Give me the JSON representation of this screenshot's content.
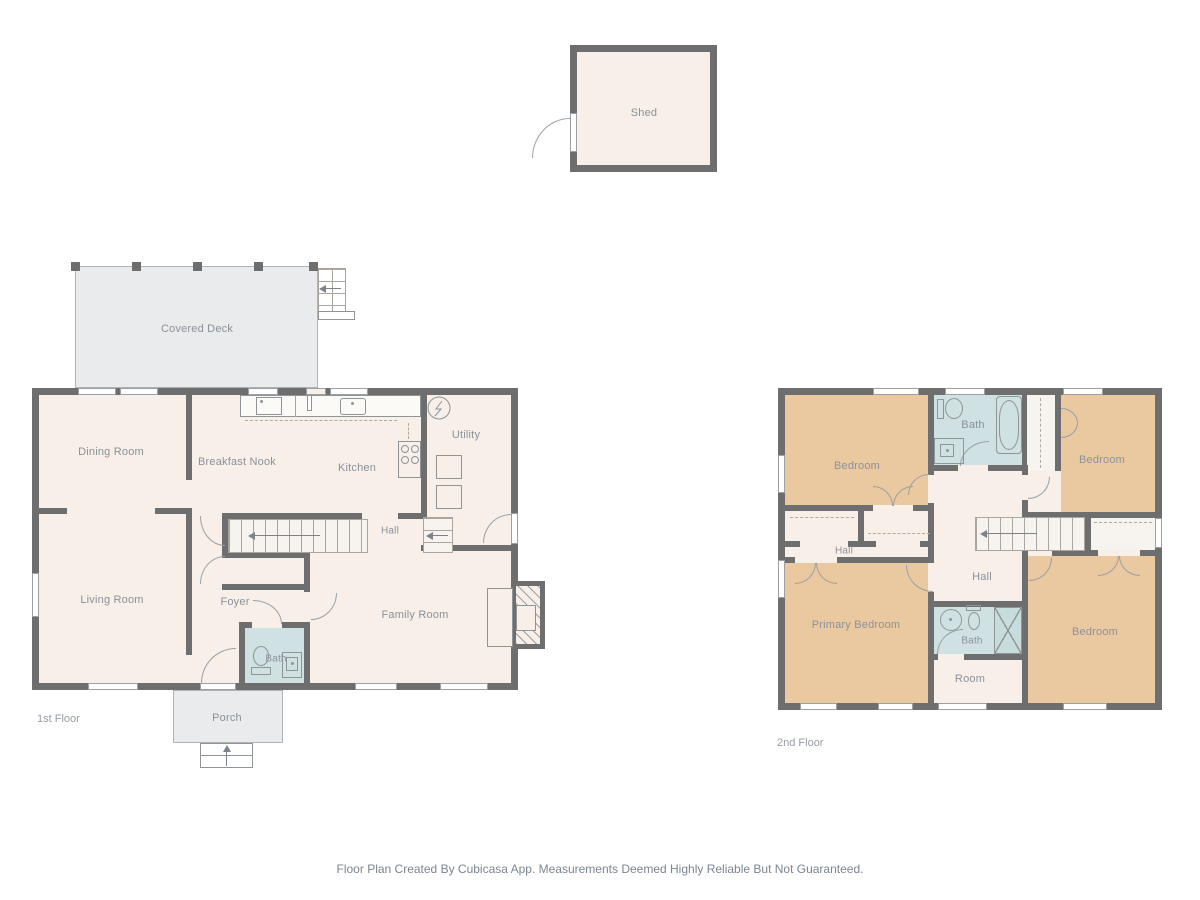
{
  "footer": {
    "text": "Floor Plan Created By Cubicasa App. Measurements Deemed Highly Reliable But Not Guaranteed."
  },
  "shed": {
    "label": "Shed"
  },
  "floor1": {
    "title": "1st Floor",
    "rooms": {
      "covered_deck": "Covered Deck",
      "dining_room": "Dining Room",
      "breakfast_nook": "Breakfast Nook",
      "kitchen": "Kitchen",
      "utility": "Utility",
      "hall": "Hall",
      "living_room": "Living Room",
      "foyer": "Foyer",
      "bath": "Bath",
      "family_room": "Family Room",
      "porch": "Porch"
    }
  },
  "floor2": {
    "title": "2nd Floor",
    "rooms": {
      "bedroom_nw": "Bedroom",
      "bath_upper": "Bath",
      "bedroom_ne": "Bedroom",
      "hall_west": "Hall",
      "hall_center": "Hall",
      "primary_bedroom": "Primary Bedroom",
      "bath_lower": "Bath",
      "room": "Room",
      "bedroom_se": "Bedroom"
    }
  },
  "colors": {
    "wall": "#6e6e6e",
    "room_floor": "#f7efe8",
    "bedroom_floor": "#ebc9a0",
    "bath_floor": "#cfe1e2",
    "deck_floor": "#e9ebec",
    "label_text": "#8b919a"
  }
}
